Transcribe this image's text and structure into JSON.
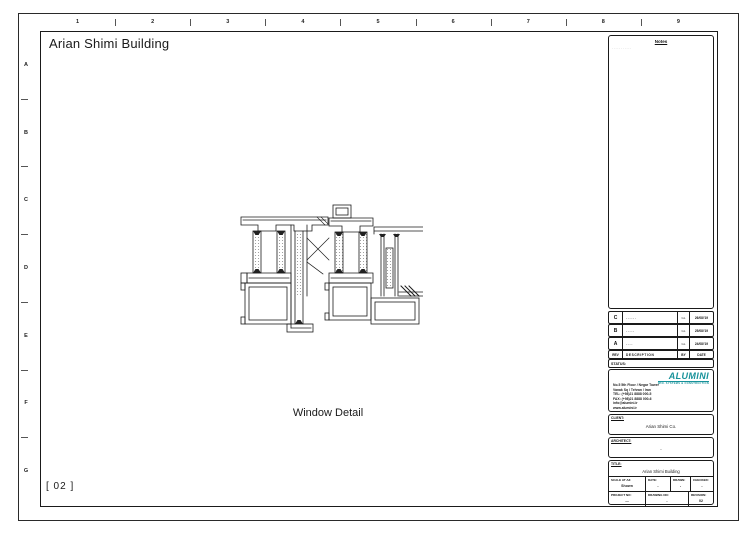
{
  "sheet": {
    "title": "Arian Shimi Building",
    "drawing_label": "Window Detail",
    "sheet_number": "[ 02 ]",
    "grid_columns": [
      "1",
      "2",
      "3",
      "4",
      "5",
      "6",
      "7",
      "8",
      "9"
    ],
    "grid_rows": [
      "A",
      "B",
      "C",
      "D",
      "E",
      "F",
      "G"
    ]
  },
  "notes": {
    "label": "Notes",
    "content": "..........."
  },
  "revision_table": {
    "headers": {
      "rev": "REV",
      "description": "DESCRIPTION",
      "by": "BY",
      "date": "DATE"
    },
    "status_label": "STATUS:",
    "rows": [
      {
        "rev": "C",
        "description": "------",
        "by": "GL",
        "date": "26/08/'19"
      },
      {
        "rev": "B",
        "description": "-----",
        "by": "GL",
        "date": "25/08/'19"
      },
      {
        "rev": "A",
        "description": "----",
        "by": "GL",
        "date": "24/08/'19"
      }
    ]
  },
  "company": {
    "logo_text": "ALUMINI",
    "tagline": "WIN. SYSTEMS & CONSTRUCTION",
    "accent_color": "#17929a",
    "address_lines": [
      "No.5 5th Floor / Negar Tower",
      "Vanak Sq / Tehran / Iran",
      "TEL: (+98)21 8888 000-5",
      "FAX: (+98)21 8888 000-6",
      "info@alumini.ir",
      "www.alumini.ir"
    ]
  },
  "client": {
    "label": "CLIENT:",
    "value": "Arian Shimi Co."
  },
  "architect": {
    "label": "ARCHITECT:",
    "value": "-"
  },
  "title_block": {
    "title_label": "TITLE:",
    "title_value": "Arian Shimi Building",
    "fields": {
      "scale": {
        "label": "SCALE AT A3:",
        "value": "Shown"
      },
      "date": {
        "label": "DATE:",
        "value": "-"
      },
      "drawn": {
        "label": "DRAWN:",
        "value": "-"
      },
      "checked": {
        "label": "CHECKED:",
        "value": "-"
      },
      "project_no": {
        "label": "PROJECT NO:",
        "value": "—"
      },
      "drawing_no": {
        "label": "DRAWING NO:",
        "value": "-"
      },
      "revision": {
        "label": "REVISION:",
        "value": "02"
      }
    }
  }
}
